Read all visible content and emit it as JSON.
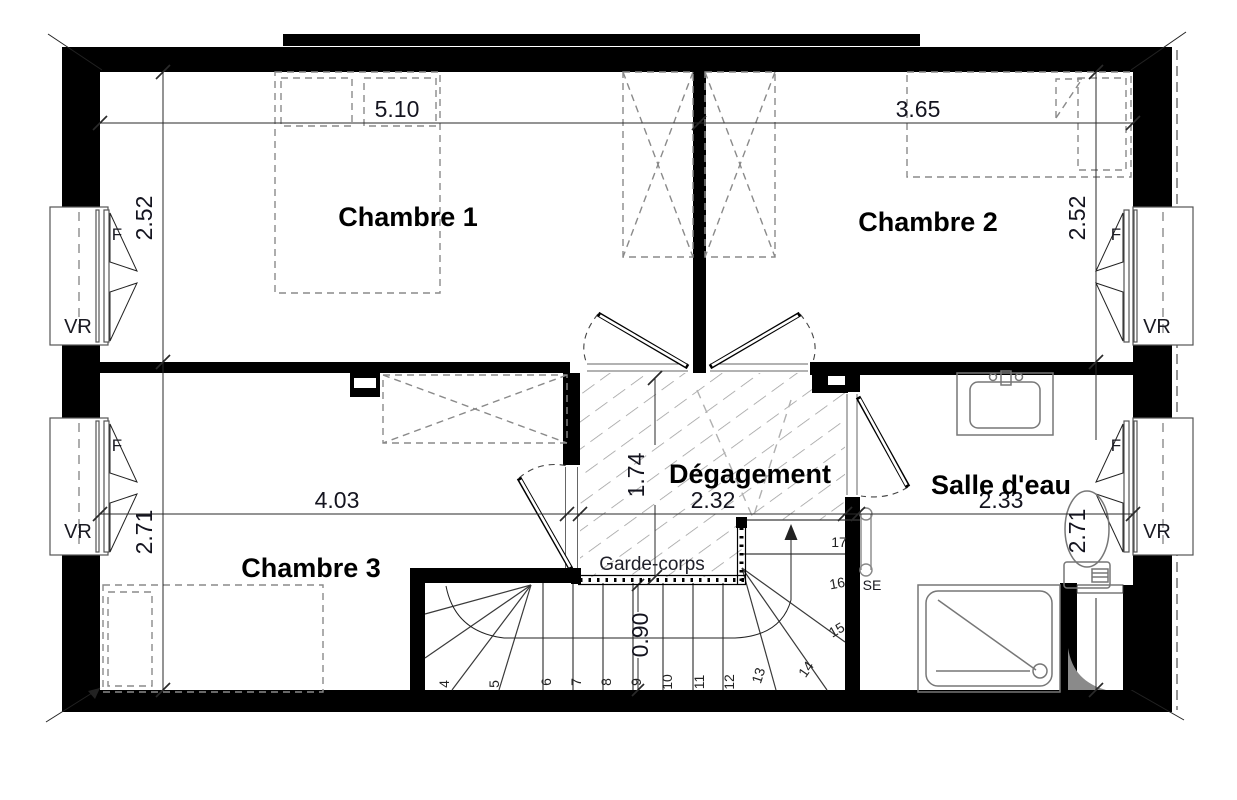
{
  "plan": {
    "rooms": {
      "chambre1": "Chambre 1",
      "chambre2": "Chambre 2",
      "chambre3": "Chambre 3",
      "degagement": "Dégagement",
      "salle_eau": "Salle d'eau"
    },
    "features": {
      "garde_corps": "Garde-corps",
      "towel_radiator": "SE"
    },
    "window_labels": {
      "window": "F",
      "roller_shutter": "VR"
    },
    "dimensions": {
      "chambre1_width": "5.10",
      "chambre2_width": "3.65",
      "chambre1_height": "2.52",
      "chambre2_height": "2.52",
      "chambre3_width": "4.03",
      "chambre3_height": "2.71",
      "salle_eau_width": "2.33",
      "salle_eau_height": "2.71",
      "degagement_width": "2.32",
      "degagement_height": "1.74",
      "stair_width": "0.90"
    },
    "stair_steps": [
      "4",
      "5",
      "6",
      "7",
      "8",
      "9",
      "10",
      "11",
      "12",
      "13",
      "14",
      "15",
      "16",
      "17"
    ]
  }
}
